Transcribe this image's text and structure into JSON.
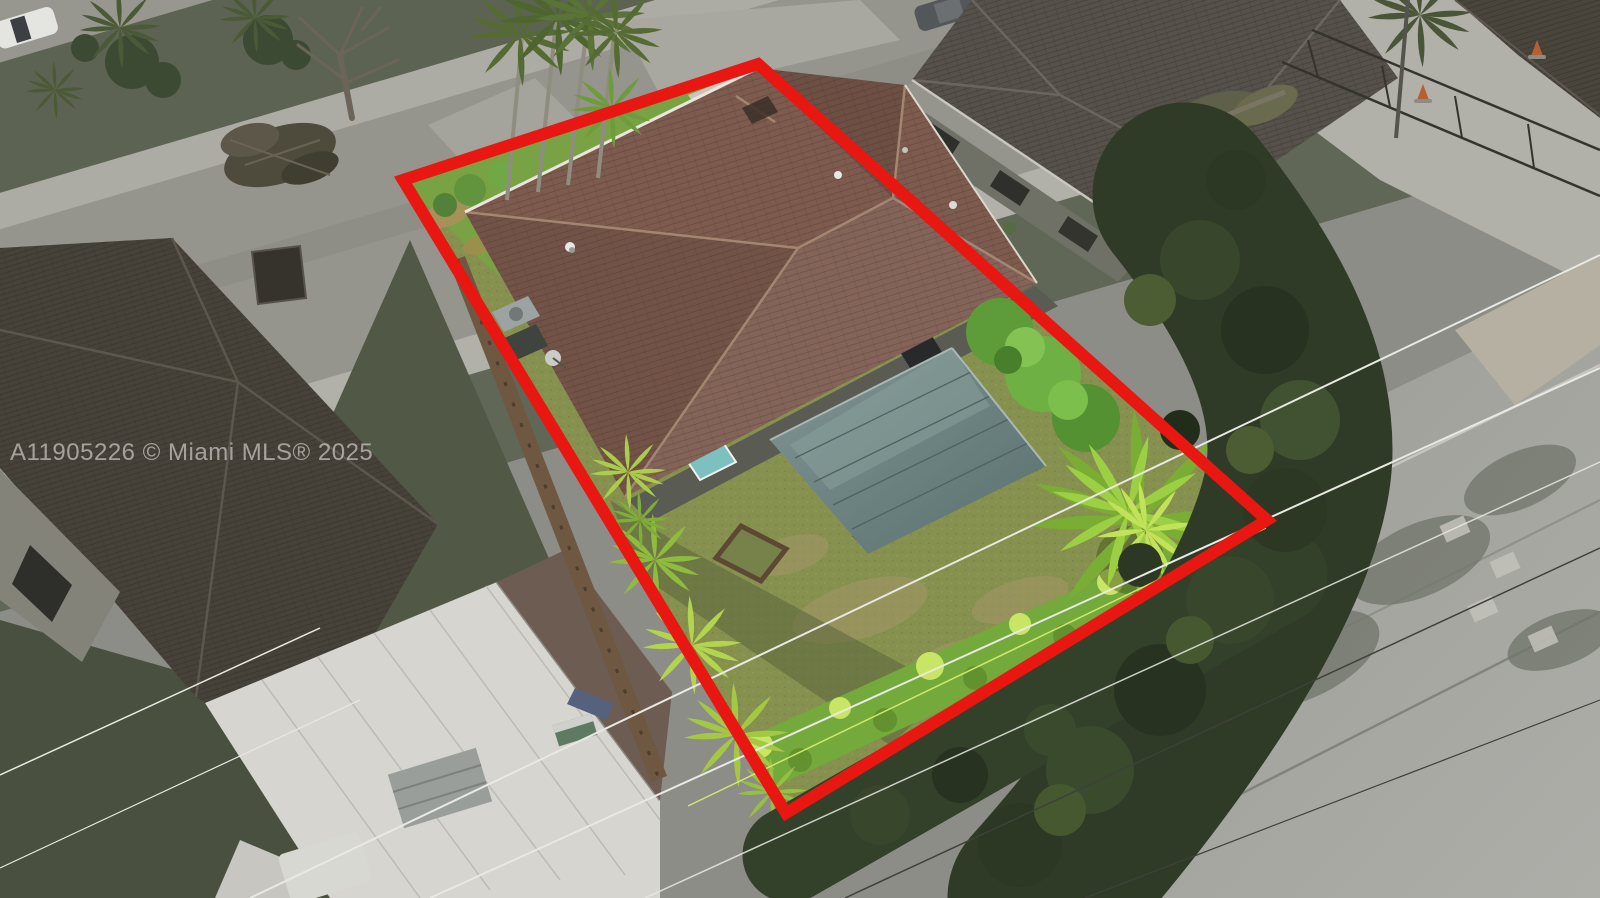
{
  "image": {
    "kind": "aerial-drone-photo",
    "subject": "single-family home with brown tile roof, screened porch, fenced backyard and palm trees; surrounding neighborhood desaturated",
    "width_px": 1600,
    "height_px": 898
  },
  "watermark": {
    "text": "A11905226 © Miami MLS® 2025",
    "color": "rgba(242,242,242,0.55)",
    "font_size_px": 24
  },
  "boundary_overlay": {
    "color": "#e81711",
    "stroke_width": 12,
    "points": "403,180 758,64 1267,520 786,813"
  },
  "palette": {
    "boundary_red": "#e81711",
    "subject_roof_brown": "#7d5b4e",
    "roof_ridge_light": "#a28672",
    "porch_roof_teal": "#6f8583",
    "backyard_lawn_green": "#87914f",
    "front_lawn_green": "#79a244",
    "bright_palm_green": "#a9ce49",
    "hedge_dark_green": "#2f3b26",
    "street_gray": "#95948d",
    "sidewalk_gray": "#b2b1a9",
    "neighbor_roof_dark": "#474239",
    "white_metal_roof": "#d6d5d0",
    "road_gray": "#a4a49f",
    "sand_tan": "#b5b0a2",
    "power_line_white": "#e9e9e4",
    "fence_brown": "#6e5842",
    "window_teal": "#7cc0bf"
  }
}
